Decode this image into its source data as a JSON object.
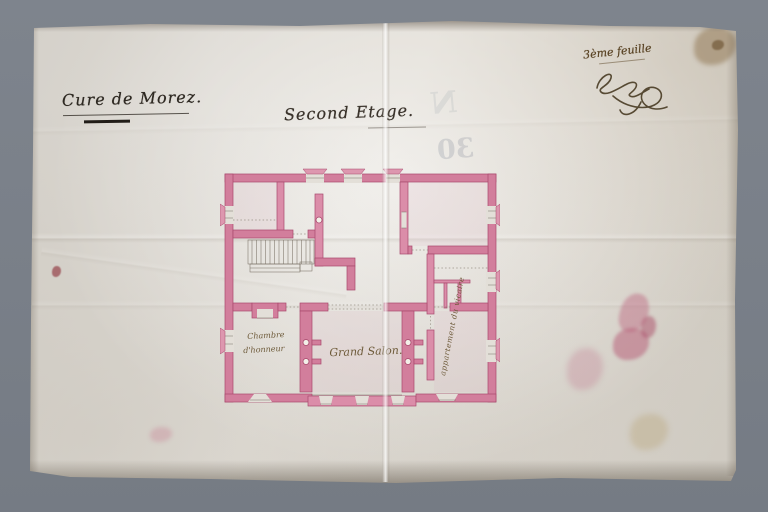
{
  "photo": {
    "background_color": "#7b828b"
  },
  "paper": {
    "color": "#dcd8d1"
  },
  "inscriptions": {
    "project_title": "Cure de Morez.",
    "floor_title": "Second Etage.",
    "sheet_note": "3ème feuille",
    "signature": "Chaley",
    "bleedthrough_number": "30",
    "bleedthrough_letter": "N"
  },
  "plan": {
    "type": "floor-plan",
    "wall_color": "#d27e9c",
    "wall_edge_color": "#a8496d",
    "rooms": [
      {
        "id": "chambre-honneur",
        "label_line1": "Chambre",
        "label_line2": "d'honneur"
      },
      {
        "id": "grand-salon",
        "label": "Grand Salon."
      },
      {
        "id": "appartement-vicaire",
        "label": "appartement du vicaire",
        "orientation": "vertical"
      }
    ]
  }
}
